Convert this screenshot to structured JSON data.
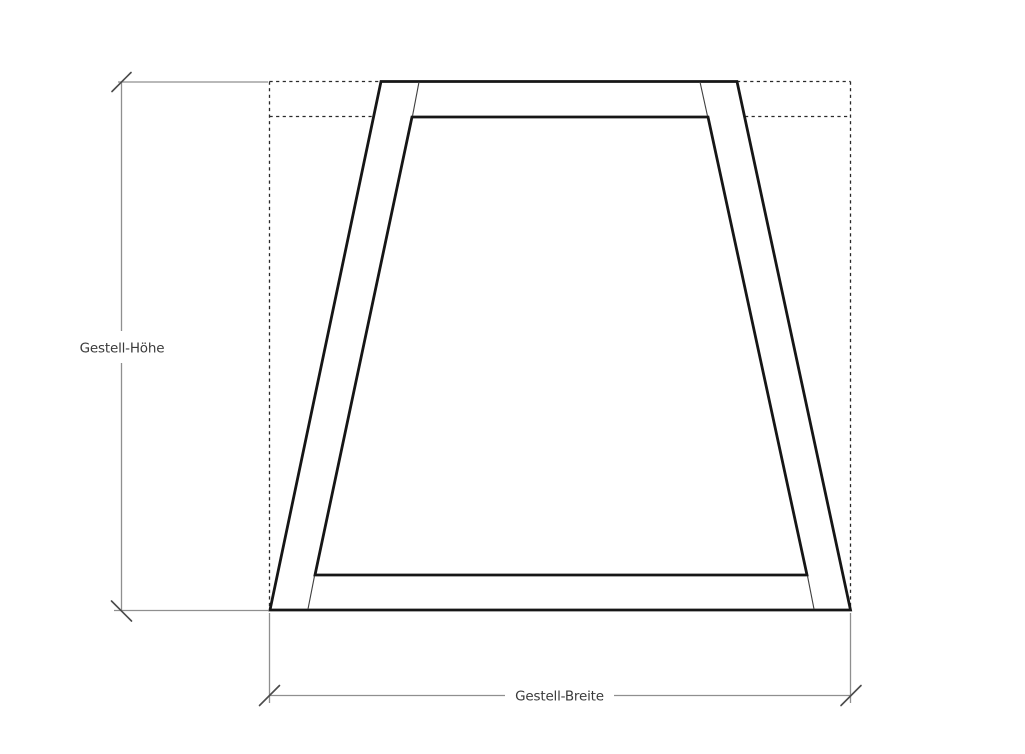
{
  "drawing": {
    "description": "technical-dimension-drawing-of-trapezoid-frame",
    "labels": {
      "height_label": "Gestell-Höhe",
      "width_label": "Gestell-Breite"
    },
    "colors": {
      "background": "#ffffff",
      "frame_stroke": "#161616",
      "joint_line": "#3f3f3f",
      "dashed_reference": "#2a2a2a",
      "dimension_line": "#8f8f8f",
      "dimension_tick": "#4a4a4a",
      "label_text": "#3a3a3a"
    }
  }
}
